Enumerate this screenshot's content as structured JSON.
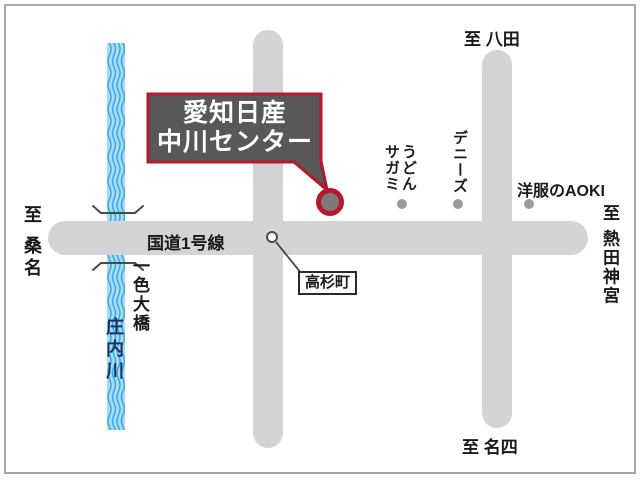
{
  "map": {
    "callout": {
      "line1": "愛知日産",
      "line2": "中川センター"
    },
    "route_label": "国道1号線",
    "intersection": "高杉町",
    "destinations": {
      "north": "至 八田",
      "west": "至 桑名",
      "east": "至 熱田神宮",
      "south": "至 名四"
    },
    "river": {
      "name": "庄内川",
      "bridge": "一色大橋"
    },
    "landmarks": {
      "sagami": {
        "line1": "うどん",
        "line2": "サガミ"
      },
      "dennys": {
        "label": "デニーズ"
      },
      "aoki": {
        "label": "洋服のAOKI"
      }
    },
    "colors": {
      "road": "#d4d4d6",
      "river_bg": "#a9dbf5",
      "river_wave": "#35ade2",
      "callout_bg": "#595757",
      "callout_border": "#b5182f",
      "marker_inner": "#7b7b7b",
      "landmark_dot": "#9b9b9b",
      "river_text": "#1c3363",
      "frame_border": "#a8a8a8"
    }
  }
}
